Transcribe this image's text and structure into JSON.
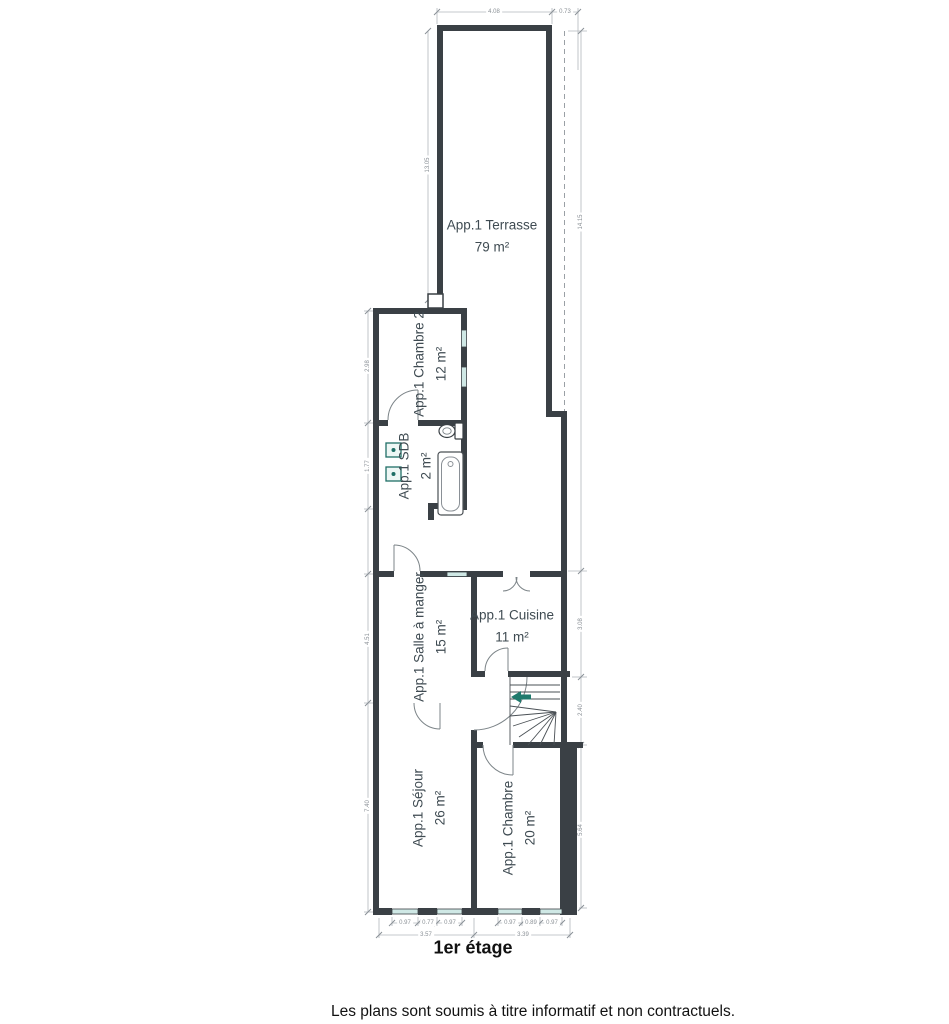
{
  "plan": {
    "title": "1er étage",
    "footer": "Les plans sont soumis à titre informatif et non contractuels."
  },
  "rooms": [
    {
      "id": "terrasse",
      "name": "App.1 Terrasse",
      "area": "79 m²"
    },
    {
      "id": "chambre2",
      "name": "App.1 Chambre 2",
      "area": "12 m²"
    },
    {
      "id": "sdb",
      "name": "App.1 SDB",
      "area": "2 m²"
    },
    {
      "id": "salle-a-manger",
      "name": "App.1 Salle à manger",
      "area": "15 m²"
    },
    {
      "id": "cuisine",
      "name": "App.1 Cuisine",
      "area": "11 m²"
    },
    {
      "id": "sejour",
      "name": "App.1 Séjour",
      "area": "26 m²"
    },
    {
      "id": "chambre",
      "name": "App.1 Chambre",
      "area": "20 m²"
    }
  ],
  "dims": {
    "top": [
      "4.08",
      "0.73"
    ],
    "terrace_left": "13.05",
    "right": [
      "14.15",
      "3.08",
      "2.40",
      "5.64"
    ],
    "left": [
      "2.98",
      "1.77",
      "4.51",
      "7.40"
    ],
    "windows_sejour": [
      "0.97",
      "0.77",
      "0.97"
    ],
    "windows_chambre": [
      "0.97",
      "0.89",
      "0.97"
    ],
    "bottom_widths": [
      "3.57",
      "3.39"
    ]
  },
  "colors": {
    "wall": "#3a4045",
    "window_fill": "#cfe8e5",
    "fixture_teal": "#1f7a6d",
    "room_text": "#3f4b52",
    "dim_text": "#8a9096"
  }
}
